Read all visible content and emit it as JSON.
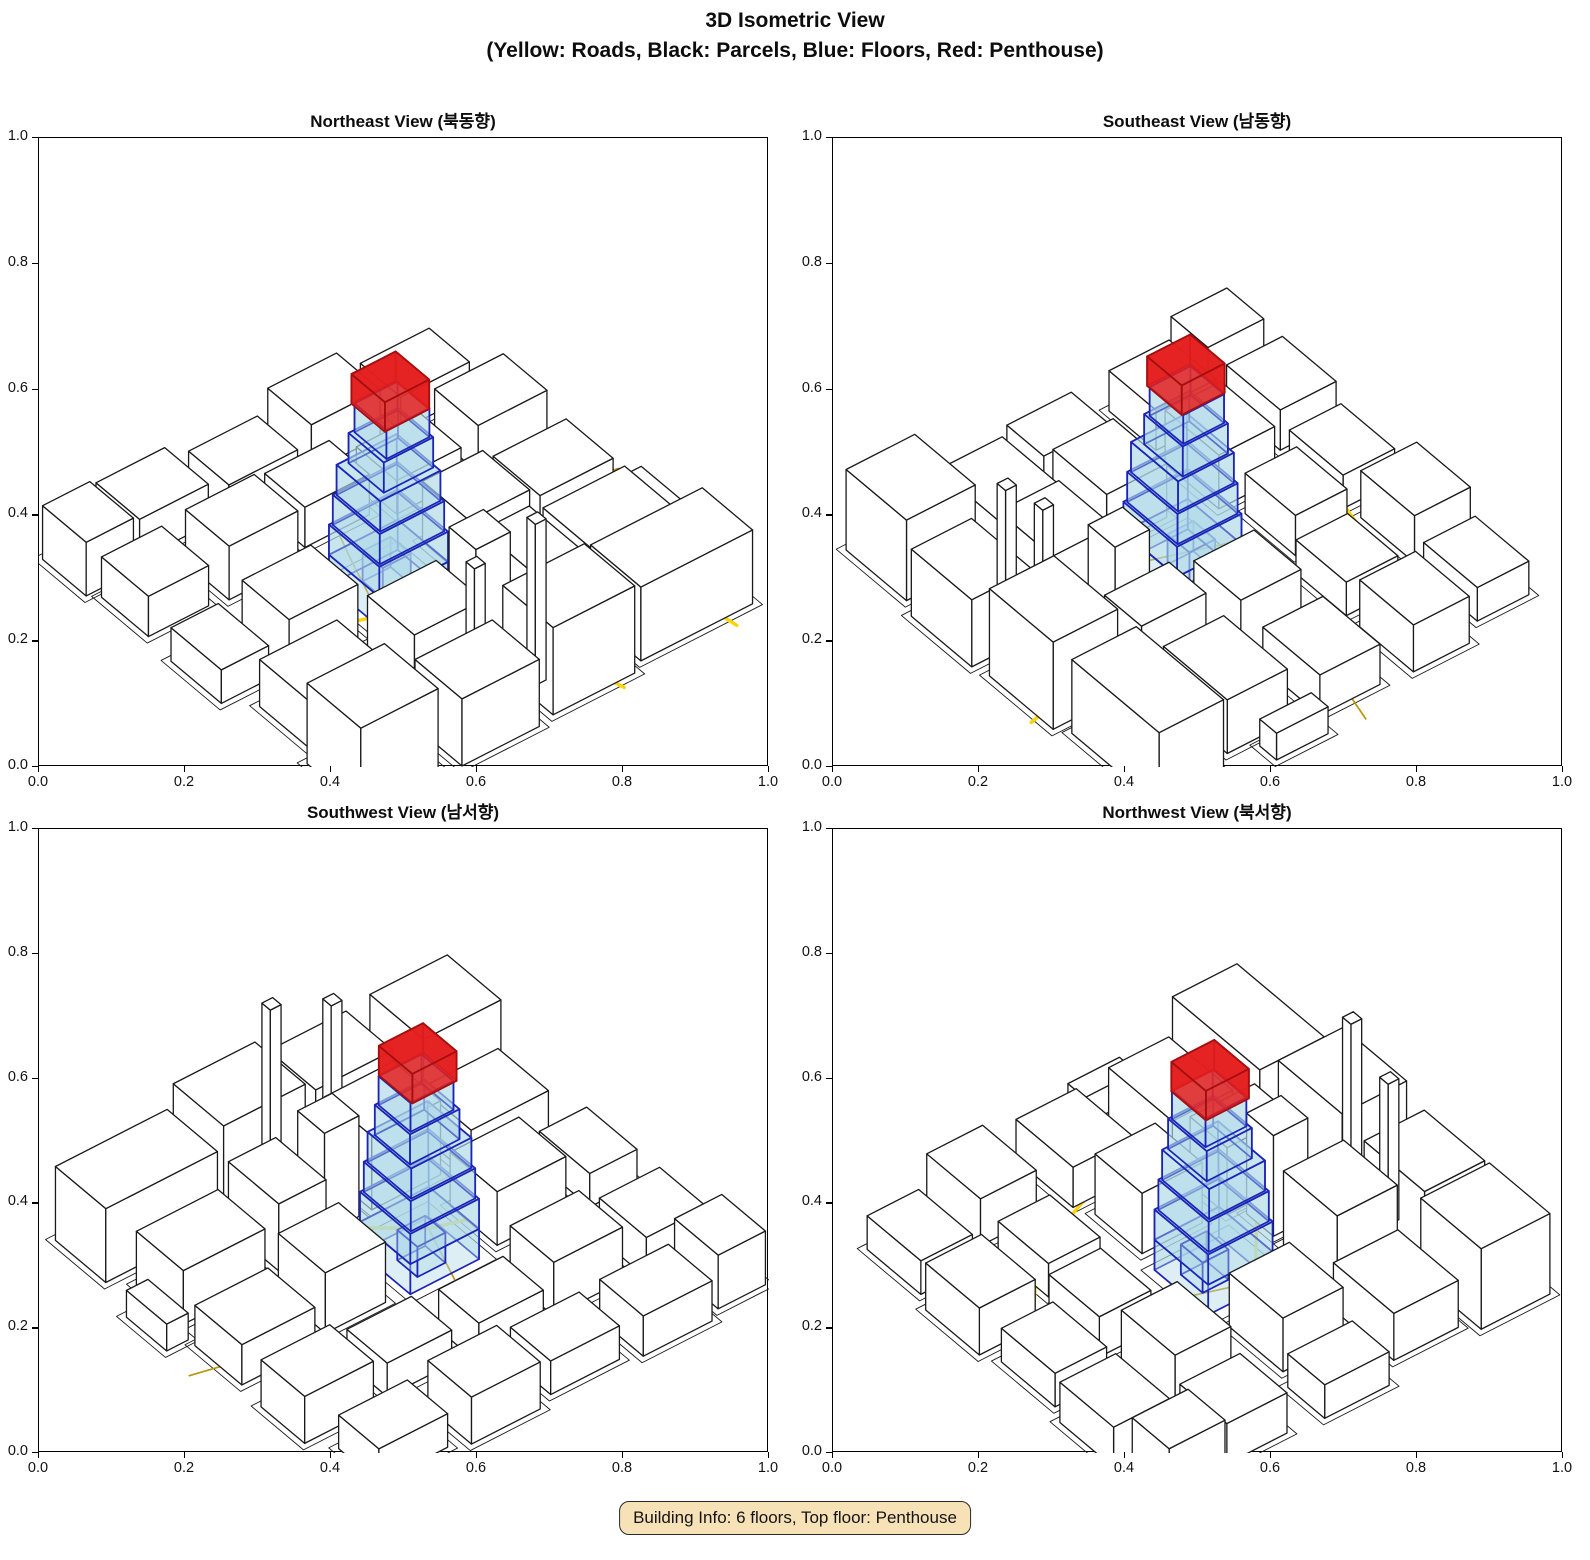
{
  "figure": {
    "title_line1": "3D Isometric View",
    "title_line2": "(Yellow: Roads, Black: Parcels, Blue: Floors, Red: Penthouse)"
  },
  "badge": {
    "text": "Building Info: 6 floors, Top floor: Penthouse"
  },
  "axes": {
    "xlim": [
      0.0,
      1.0
    ],
    "ylim": [
      0.0,
      1.0
    ],
    "tick_labels": [
      "0.0",
      "0.2",
      "0.4",
      "0.6",
      "0.8",
      "1.0"
    ]
  },
  "colors": {
    "road_major": "#FFD400",
    "road_minor": "#B8960C",
    "parcel_line": "#1a1a1a",
    "building_fill": "#ffffff",
    "building_edge": "#1a1a1a",
    "floor_fill": "#ADD8E6",
    "floor_edge": "#1C24B8",
    "penthouse_fill": "#E41F1F",
    "penthouse_edge": "#A50F0F",
    "badge_bg": "#F7E2B8"
  },
  "chart_data": {
    "type": "3d_isometric_multiview",
    "title": "3D Isometric View",
    "subtitle": "(Yellow: Roads, Black: Parcels, Blue: Floors, Red: Penthouse)",
    "legend": {
      "roads": "Yellow",
      "parcels": "Black",
      "floors": "Blue",
      "penthouse": "Red"
    },
    "elevation_deg": 28,
    "views": [
      {
        "id": "northeast",
        "label": "Northeast View (북동향)",
        "azimuth_deg": 52
      },
      {
        "id": "southeast",
        "label": "Southeast View (남동향)",
        "azimuth_deg": 142
      },
      {
        "id": "southwest",
        "label": "Southwest View (남서향)",
        "azimuth_deg": 232
      },
      {
        "id": "northwest",
        "label": "Northwest View (북서향)",
        "azimuth_deg": 322
      }
    ],
    "building": {
      "floors": 6,
      "top_floor": "Penthouse",
      "parcel": [
        0.445,
        0.41,
        0.645,
        0.615
      ],
      "floor_boxes": [
        [
          0.46,
          0.43,
          0.62,
          0.58,
          0.0,
          0.045
        ],
        [
          0.5,
          0.46,
          0.565,
          0.52,
          0.0,
          0.045
        ],
        [
          0.46,
          0.43,
          0.62,
          0.58,
          0.045,
          0.09
        ],
        [
          0.465,
          0.435,
          0.615,
          0.575,
          0.09,
          0.135
        ],
        [
          0.47,
          0.44,
          0.61,
          0.57,
          0.135,
          0.18
        ],
        [
          0.475,
          0.45,
          0.59,
          0.555,
          0.18,
          0.225
        ],
        [
          0.48,
          0.455,
          0.58,
          0.55,
          0.225,
          0.268
        ]
      ],
      "penthouse_box": [
        0.482,
        0.452,
        0.585,
        0.552,
        0.268,
        0.312
      ]
    },
    "city": {
      "buildings": [
        [
          0.04,
          0.8,
          0.3,
          0.95,
          0.11
        ],
        [
          0.33,
          0.82,
          0.52,
          0.97,
          0.13
        ],
        [
          0.56,
          0.84,
          0.74,
          0.98,
          0.1
        ],
        [
          0.78,
          0.8,
          0.96,
          0.96,
          0.12
        ],
        [
          0.08,
          0.62,
          0.27,
          0.76,
          0.08
        ],
        [
          0.31,
          0.63,
          0.42,
          0.78,
          0.1
        ],
        [
          0.55,
          0.66,
          0.71,
          0.8,
          0.11
        ],
        [
          0.75,
          0.62,
          0.93,
          0.77,
          0.07
        ],
        [
          0.06,
          0.42,
          0.23,
          0.56,
          0.06
        ],
        [
          0.27,
          0.44,
          0.41,
          0.58,
          0.09
        ],
        [
          0.67,
          0.44,
          0.83,
          0.58,
          0.08
        ],
        [
          0.87,
          0.42,
          0.98,
          0.57,
          0.05
        ],
        [
          0.05,
          0.22,
          0.21,
          0.35,
          0.07
        ],
        [
          0.25,
          0.23,
          0.4,
          0.35,
          0.05
        ],
        [
          0.44,
          0.2,
          0.59,
          0.32,
          0.06
        ],
        [
          0.63,
          0.22,
          0.79,
          0.35,
          0.08
        ],
        [
          0.83,
          0.2,
          0.97,
          0.34,
          0.06
        ],
        [
          0.09,
          0.05,
          0.25,
          0.17,
          0.05
        ],
        [
          0.29,
          0.03,
          0.45,
          0.16,
          0.07
        ],
        [
          0.49,
          0.05,
          0.65,
          0.17,
          0.05
        ],
        [
          0.69,
          0.03,
          0.85,
          0.16,
          0.06
        ],
        [
          0.88,
          0.05,
          0.99,
          0.18,
          0.08
        ],
        [
          0.44,
          0.66,
          0.52,
          0.74,
          0.15
        ],
        [
          0.47,
          0.86,
          0.495,
          0.885,
          0.24
        ],
        [
          0.6,
          0.845,
          0.625,
          0.87,
          0.21
        ],
        [
          0.01,
          0.58,
          0.06,
          0.7,
          0.04
        ]
      ],
      "roads_major": [
        [
          [
            0.1,
            0.98
          ],
          [
            0.125,
            0.8
          ],
          [
            0.17,
            0.62
          ],
          [
            0.23,
            0.44
          ],
          [
            0.3,
            0.28
          ],
          [
            0.42,
            0.18
          ],
          [
            0.58,
            0.145
          ],
          [
            0.74,
            0.13
          ],
          [
            0.92,
            0.155
          ]
        ],
        [
          [
            0.37,
            0.99
          ],
          [
            0.41,
            0.82
          ],
          [
            0.47,
            0.66
          ],
          [
            0.6,
            0.555
          ],
          [
            0.76,
            0.5
          ],
          [
            0.94,
            0.49
          ]
        ]
      ],
      "roads_minor": [
        [
          [
            0.0,
            0.5
          ],
          [
            0.1,
            0.475
          ],
          [
            0.23,
            0.435
          ]
        ],
        [
          [
            0.6,
            0.555
          ],
          [
            0.545,
            0.4
          ],
          [
            0.52,
            0.335
          ]
        ]
      ]
    }
  }
}
